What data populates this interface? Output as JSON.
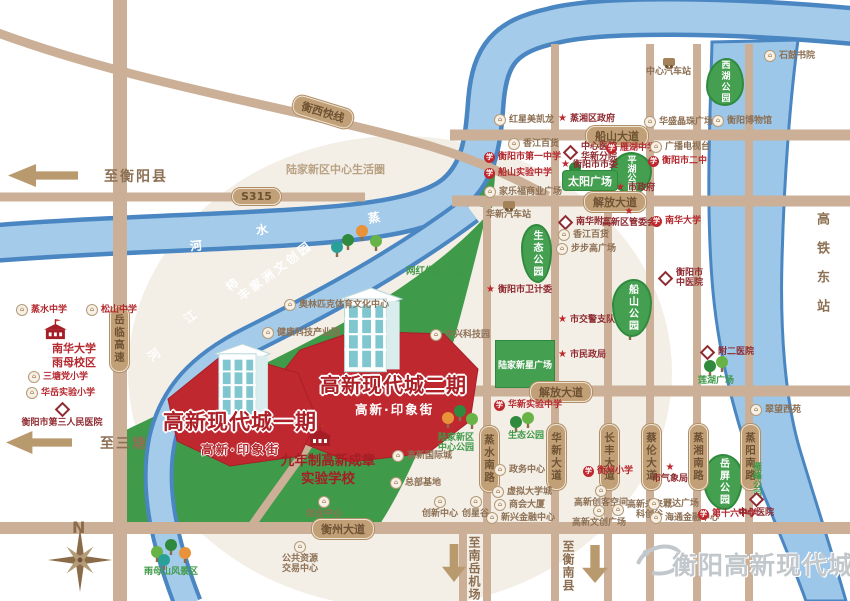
{
  "map": {
    "roads": {
      "s315": "S315",
      "hengxi": "衡西快线",
      "yuelin": "岳临高速",
      "chuanshan_ave": "船山大道",
      "jiefang_ave_n": "解放大道",
      "jiefang_ave_s": "解放大道",
      "hengzhou_ave": "衡州大道",
      "zhengshui_s": "蒸水南路",
      "huaxin_ave": "华新大道",
      "changfeng_ave": "长丰大道",
      "cailun_ave": "蔡伦大道",
      "zhengxiang_s": "蒸湘南路",
      "zhengyang_s": "蒸阳南路"
    },
    "rivers": {
      "zhengshui": [
        "蒸",
        "水",
        "河"
      ],
      "shijiang": [
        "柿",
        "江",
        "河"
      ],
      "xiangjiang": [
        "湘",
        "江"
      ]
    },
    "zones": {
      "life_circle": "陆家新区中心生活圈",
      "wenchuang": "丰家洲文创园",
      "eco_corridor": "网红生态长廊"
    },
    "plots": {
      "phase2": {
        "title": "高新现代城二期",
        "street": "高新·印象街"
      },
      "phase1": {
        "title": "高新现代城一期",
        "street": "高新·印象街"
      },
      "school": "九年制高新成章\n实验学校",
      "nanhua_campus": "南华大学\n雨母校区"
    },
    "parks": {
      "xihu": "西湖公园",
      "pinghu": "平湖公园",
      "chuanshan": "船山公园",
      "eco_north": "生态公园",
      "eco_south": "生态公园",
      "yueping": "岳屏公园",
      "yanfeng": "雁峰公园",
      "lianhu": "莲湖广场",
      "taiyang": "太阳广场",
      "lujia_star_plaza": "陆家新星广场",
      "central_park": "陆家新区\n中心公园",
      "yumu": "雨母山风景区"
    },
    "pois": {
      "zhengshui_middle": "蒸水中学",
      "songshan_middle": "松山中学",
      "santang_primary": "三塘党小学",
      "huayue_primary": "华岳实验小学",
      "no3_hospital": "衡阳市第三人民医院",
      "shigu_academy": "石鼓书院",
      "central_bus_station": "中心汽车站",
      "hongxing_meikailong": "红星美凯龙",
      "zhengxiang_gov": "蒸湘区政府",
      "huasheng_plaza": "华盛晶珠广场",
      "hengyang_museum": "衡阳博物馆",
      "xiangjiang_store_n": "香江百货",
      "no1_middle": "衡阳市第一中学",
      "chuanshan_exp_middle": "船山实验中学",
      "carrefour_plaza": "家乐福商业广场",
      "central_hospital": "中心医院\n华新分院",
      "city_committee": "衡阳市市委",
      "yanhu_middle": "雁湖中学",
      "city_gov": "市政府",
      "tv_station": "广播电视台",
      "no2_middle": "衡阳市二中",
      "nanhua_fu2": "南华附二",
      "xiangjiang_store_s": "香江百货",
      "bbg_plaza": "步步高广场",
      "gaoxin_committee": "高新区管委会",
      "nanhua_university": "南华大学",
      "tcm_hospital": "衡阳市\n中医院",
      "traffic_police": "市交警支队",
      "civil_affairs": "市民政局",
      "fu2_hospital": "附二医院",
      "hsr_east_station": "高铁东站",
      "huaxin_bus_station": "华新汽车站",
      "health_commission": "衡阳市卫计委",
      "huaxin_exp_middle": "华新实验中学",
      "gov_service_center": "政务中心",
      "virtual_university": "虚拟大学城",
      "chamber_building": "商会大厦",
      "xinxing_finance": "新兴金融中心",
      "hengzhou_primary": "衡州小学",
      "maker_space": "高新创客空间",
      "wenchuang_plaza": "高新文创广场",
      "future_city": "高新未来城\n科创谷",
      "wanda_plaza": "万达广场",
      "haitong_finance": "海通金融中心",
      "meteorology": "市气象局",
      "no16_middle": "第十六中学",
      "central_hospital_s": "中心医院",
      "cuiwang_xiyuan": "翠望西苑",
      "olympic_center": "奥林匹克体育文化中心",
      "health_tech_park": "健康科技产业园",
      "zhongxing_tech": "中兴科技园",
      "intl_city": "高新国际城",
      "hq_base": "总部基地",
      "startup_center": "创业中心",
      "innovation_center": "创新中心",
      "star_valley": "创星谷",
      "resource_center": "公共资源\n交易中心"
    },
    "arrows": {
      "to_hengyang_county": "至衡阳县",
      "to_santang": "至三塘",
      "to_nanyue_airport": "至南岳机场",
      "to_hengnan_county": "至衡南县"
    },
    "compass": {
      "north": "N"
    },
    "logo": {
      "text": "衡阳高新现代城"
    }
  }
}
